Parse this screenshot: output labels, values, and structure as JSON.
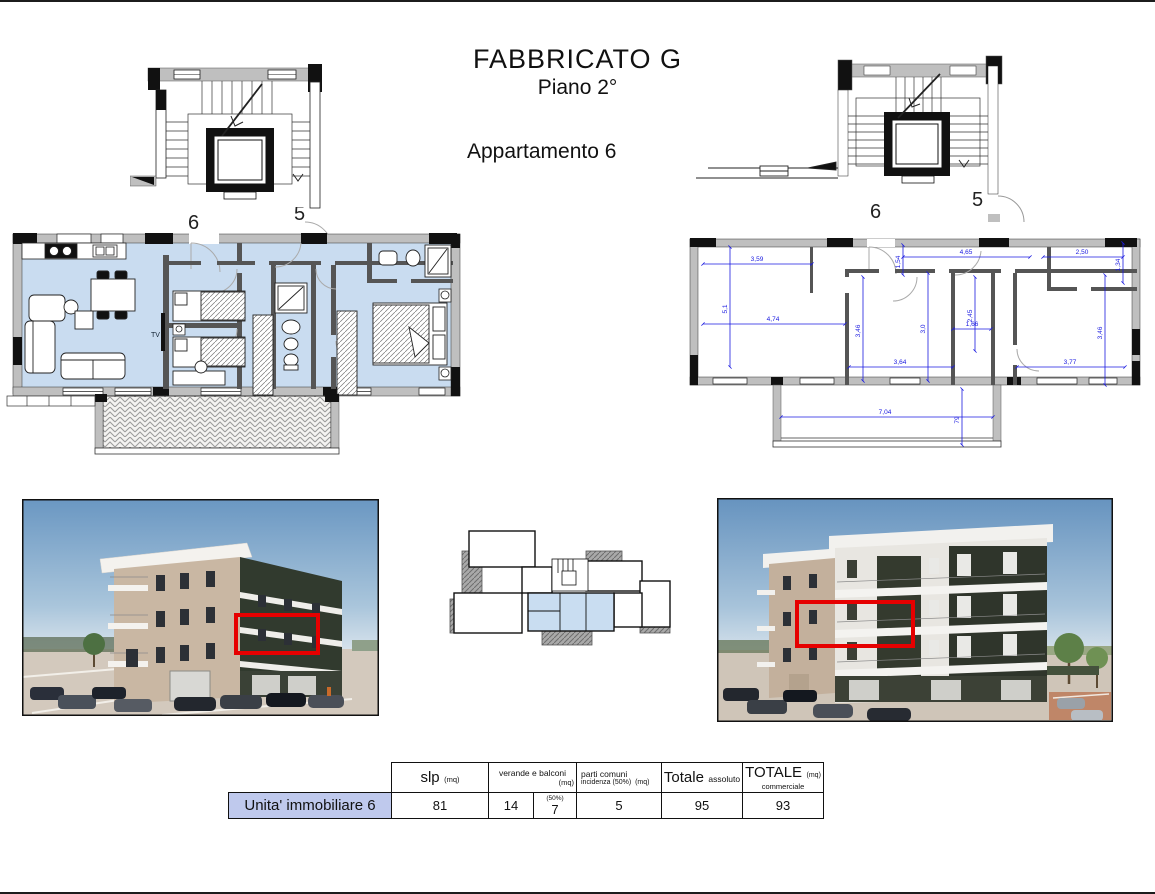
{
  "header": {
    "title": "FABBRICATO G",
    "subtitle": "Piano 2°",
    "apartment": "Appartamento 6"
  },
  "colors": {
    "plan_fill": "#c9dcf0",
    "wall_gray": "#bfbfbf",
    "dim_blue": "#1a1ae0",
    "highlight_red": "#e60000",
    "label_bg": "#bfc9ed"
  },
  "furnished_plan": {
    "unit_label": "6",
    "adjacent_label": "5",
    "tv_label": "TV"
  },
  "dimensioned_plan": {
    "unit_label": "6",
    "adjacent_label": "5",
    "dims": {
      "living_top_w": "3,59",
      "living_h": "5,1",
      "living_w": "4,74",
      "living_right_h": "3,46",
      "entry_h": "1,54",
      "bedroom1_w": "4,65",
      "bedroom1_h": "3,0",
      "bath_h": "2,45",
      "bath_w": "1,66",
      "bedroom2_top_w": "2,50",
      "bedroom2_top_h": "1,34",
      "bedroom2_h": "3,46",
      "bedroom2_w": "3,77",
      "hall_w": "3,64",
      "terrace_w": "7,04",
      "terrace_h": "79"
    }
  },
  "table": {
    "row_label": "Unita' immobiliare 6",
    "columns": {
      "slp": {
        "main": "slp",
        "unit": "(mq)"
      },
      "verande": {
        "main": "verande e balconi",
        "unit": "(mq)"
      },
      "parti": {
        "line1": "parti comuni",
        "line2": "incidenza (50%)",
        "unit": "(mq)"
      },
      "totale_assoluto": {
        "main": "Totale",
        "sub": "assoluto"
      },
      "totale_commerciale": {
        "main": "TOTALE",
        "unit": "(mq)",
        "sub": "commerciale"
      }
    },
    "values": {
      "slp": "81",
      "verande": "14",
      "verande_50_note": "(50%)",
      "verande_50": "7",
      "parti": "5",
      "totale_assoluto": "95",
      "totale_commerciale": "93"
    }
  }
}
